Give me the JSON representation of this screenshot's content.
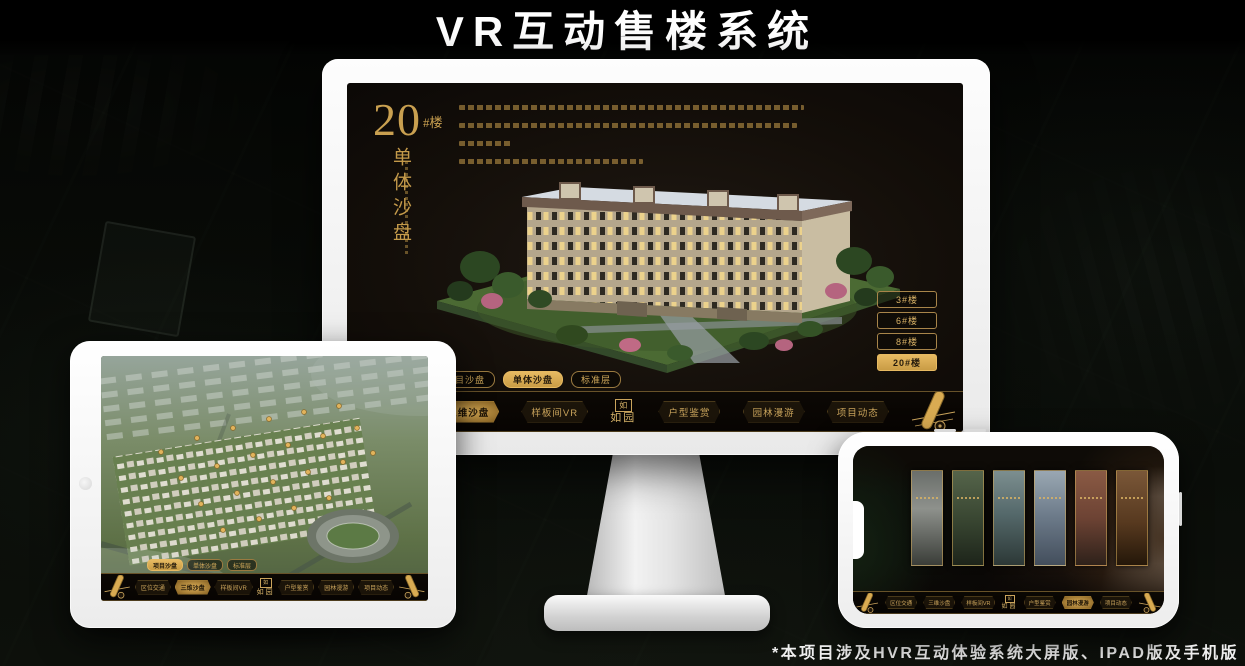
{
  "page": {
    "title": "VR互动售楼系统",
    "footnote": "*本项目涉及HVR互动体验系统大屏版、IPAD版及手机版"
  },
  "brand": {
    "logo_text": "如园",
    "logo_seal": "如"
  },
  "colors": {
    "gold": "#c9a050",
    "gold_bright": "#e7ba62",
    "screen_bg": "#130e09"
  },
  "nav": {
    "items": [
      "区位交通",
      "三维沙盘",
      "样板间VR",
      "户型鉴赏",
      "园林漫游",
      "项目动态"
    ]
  },
  "monitor": {
    "heading_number": "20",
    "heading_suffix": "#楼",
    "heading_vertical": "单体沙盘",
    "floor_buttons": [
      {
        "label": "3#楼"
      },
      {
        "label": "6#楼"
      },
      {
        "label": "8#楼"
      },
      {
        "label": "20#楼"
      }
    ],
    "sub_tabs": [
      {
        "label": "项目沙盘"
      },
      {
        "label": "单体沙盘"
      },
      {
        "label": "标准层"
      }
    ]
  },
  "ipad": {
    "sub_tabs": [
      {
        "label": "项目沙盘"
      },
      {
        "label": "单体沙盘"
      },
      {
        "label": "标准层"
      }
    ]
  }
}
